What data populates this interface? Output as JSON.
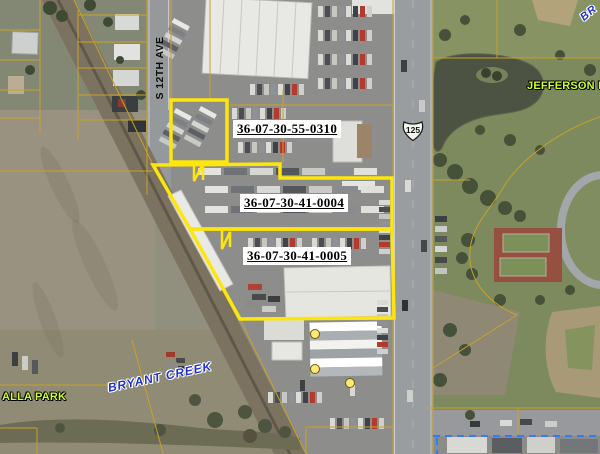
{
  "map": {
    "parcels": [
      {
        "id": "36-07-30-55-0310"
      },
      {
        "id": "36-07-30-41-0004"
      },
      {
        "id": "36-07-30-41-0005"
      }
    ],
    "streets": {
      "s12th": "S 12TH AVE"
    },
    "highway_shield": "125",
    "labels": {
      "jefferson_park": "JEFFERSON PA",
      "walla_park": "ALLA PARK",
      "bryant_creek": "BRYANT CREEK",
      "creek_top_right": "BR"
    },
    "colors": {
      "parcel_highlight": "#ffe60a",
      "cadastral_line": "#c9a227",
      "city_boundary": "#2e7cff",
      "address_point": "#ffe87a"
    }
  }
}
